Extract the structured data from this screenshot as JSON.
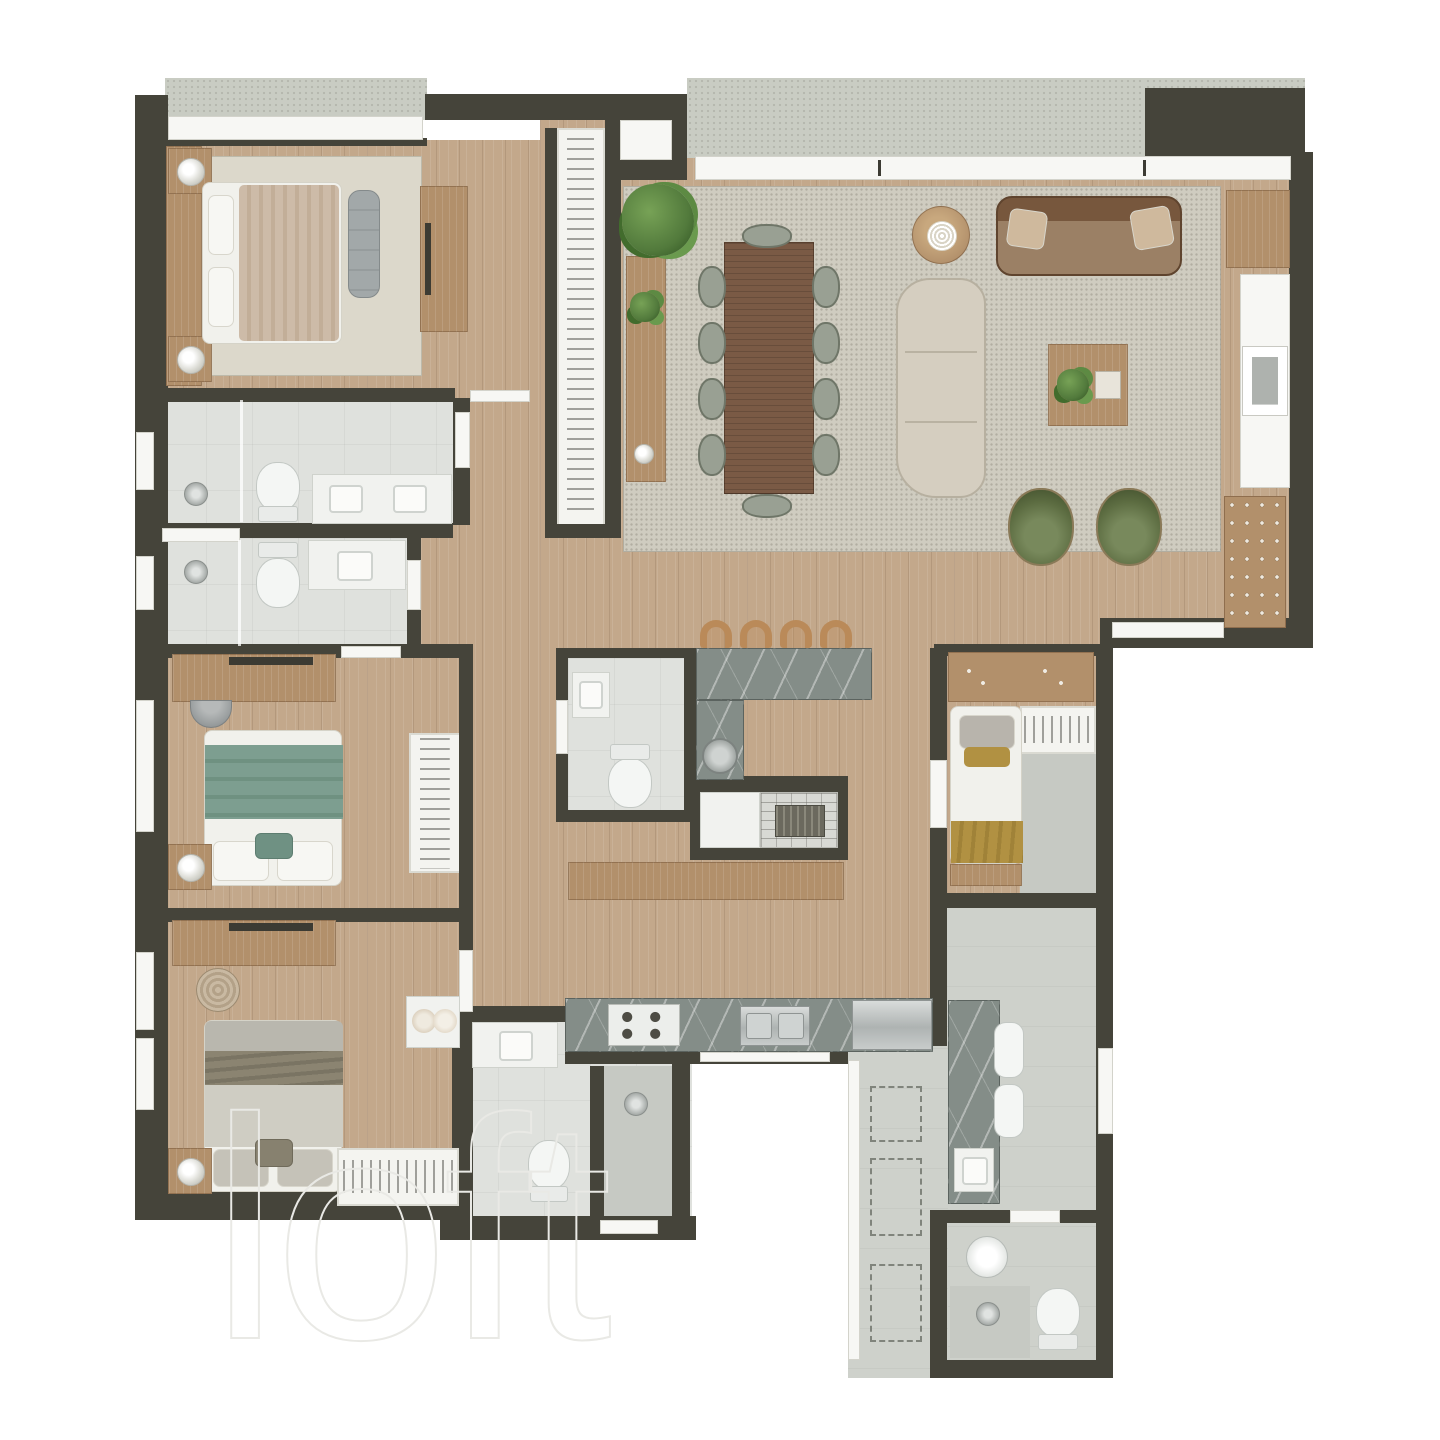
{
  "watermark": {
    "text": "loft"
  },
  "palette": {
    "wall": "#45443a",
    "wood": "#c3a88b",
    "wood_furniture": "#b2906b",
    "wood_table": "#7a5a45",
    "terrace": "#c9ccc3",
    "tile": "#dfe1dd",
    "tile_mid": "#ced1cb",
    "tile_dark": "#c6c9c3",
    "rug": "#cfccc0",
    "bedroom_rug": "#dcd8cb",
    "marble": "#848d88",
    "metal": "#b7bbba",
    "sofa_beige": "#d5cec0",
    "sofa_brown": "#8a6a4e",
    "pillow_beige": "#cfb99d",
    "green_chair": "#5c6c41",
    "green_blanket": "#7d9e90",
    "olive_blanket": "#8b8471",
    "mustard": "#b19142",
    "tan": "#ba8a59",
    "plant": "#527a3c",
    "watermark": "#e9e9e5"
  },
  "floor_plan": {
    "type": "residential-apartment-top-down-render",
    "rooms": [
      {
        "id": "terrace",
        "label": "Terrace / Balcony",
        "items": [
          "concrete floor",
          "sliding glass doors",
          "window sill"
        ]
      },
      {
        "id": "master-bedroom",
        "label": "Master Bedroom",
        "items": [
          "double bed",
          "headboard panel",
          "2 nightstands with lamps",
          "foot bench",
          "tv console",
          "area rug",
          "long wardrobe with hangers"
        ]
      },
      {
        "id": "master-bathroom-1",
        "label": "Master Bathroom 1",
        "items": [
          "walk-in shower",
          "toilet",
          "double-sink vanity",
          "towel niche",
          "window"
        ]
      },
      {
        "id": "master-bathroom-2",
        "label": "Master Bathroom 2",
        "items": [
          "walk-in shower",
          "toilet",
          "single-sink vanity",
          "window"
        ]
      },
      {
        "id": "bedroom-2",
        "label": "Bedroom 2",
        "items": [
          "desk with tv",
          "pouf",
          "double bed with green blanket",
          "nightstand with lamp",
          "wardrobe with hangers"
        ]
      },
      {
        "id": "bedroom-3",
        "label": "Bedroom 3",
        "items": [
          "desk with tv",
          "woven pouf",
          "double bed with olive blanket",
          "nightstand with lamp",
          "slatted rack",
          "towel box"
        ]
      },
      {
        "id": "hallway",
        "label": "Bedroom Hallway",
        "items": []
      },
      {
        "id": "foyer",
        "label": "Entry Foyer",
        "items": [
          "entry door"
        ]
      },
      {
        "id": "living-dining",
        "label": "Living / Dining Room",
        "items": [
          "large area rug",
          "dining table with 10 chairs",
          "buffet sideboard",
          "tall plant",
          "round side table",
          "brown leather sofa with 2 pillows",
          "beige modular sofa",
          "coffee table with plant and tray",
          "2 green armchairs",
          "wood cabinet",
          "art niche",
          "wine rack"
        ]
      },
      {
        "id": "powder-room",
        "label": "Powder Room",
        "items": [
          "washbasin",
          "toilet"
        ]
      },
      {
        "id": "kitchen",
        "label": "Kitchen",
        "items": [
          "bar counter with 4 stools",
          "corner round sink",
          "barbecue grill counter",
          "long wood sideboard",
          "marble counter",
          "4-burner cooktop",
          "double sink",
          "stainless appliance"
        ]
      },
      {
        "id": "maid-room",
        "label": "Service Bedroom",
        "items": [
          "single bed with mustard blanket",
          "shelf with decor",
          "slatted shelf",
          "closet"
        ]
      },
      {
        "id": "laundry",
        "label": "Laundry / Service Area",
        "items": [
          "marble counter",
          "2 wash basins",
          "square sink",
          "3 dashed appliance spots",
          "window strip"
        ]
      },
      {
        "id": "service-bathroom",
        "label": "Service Bathroom",
        "items": [
          "round washbasin",
          "toilet",
          "shower"
        ]
      }
    ]
  }
}
